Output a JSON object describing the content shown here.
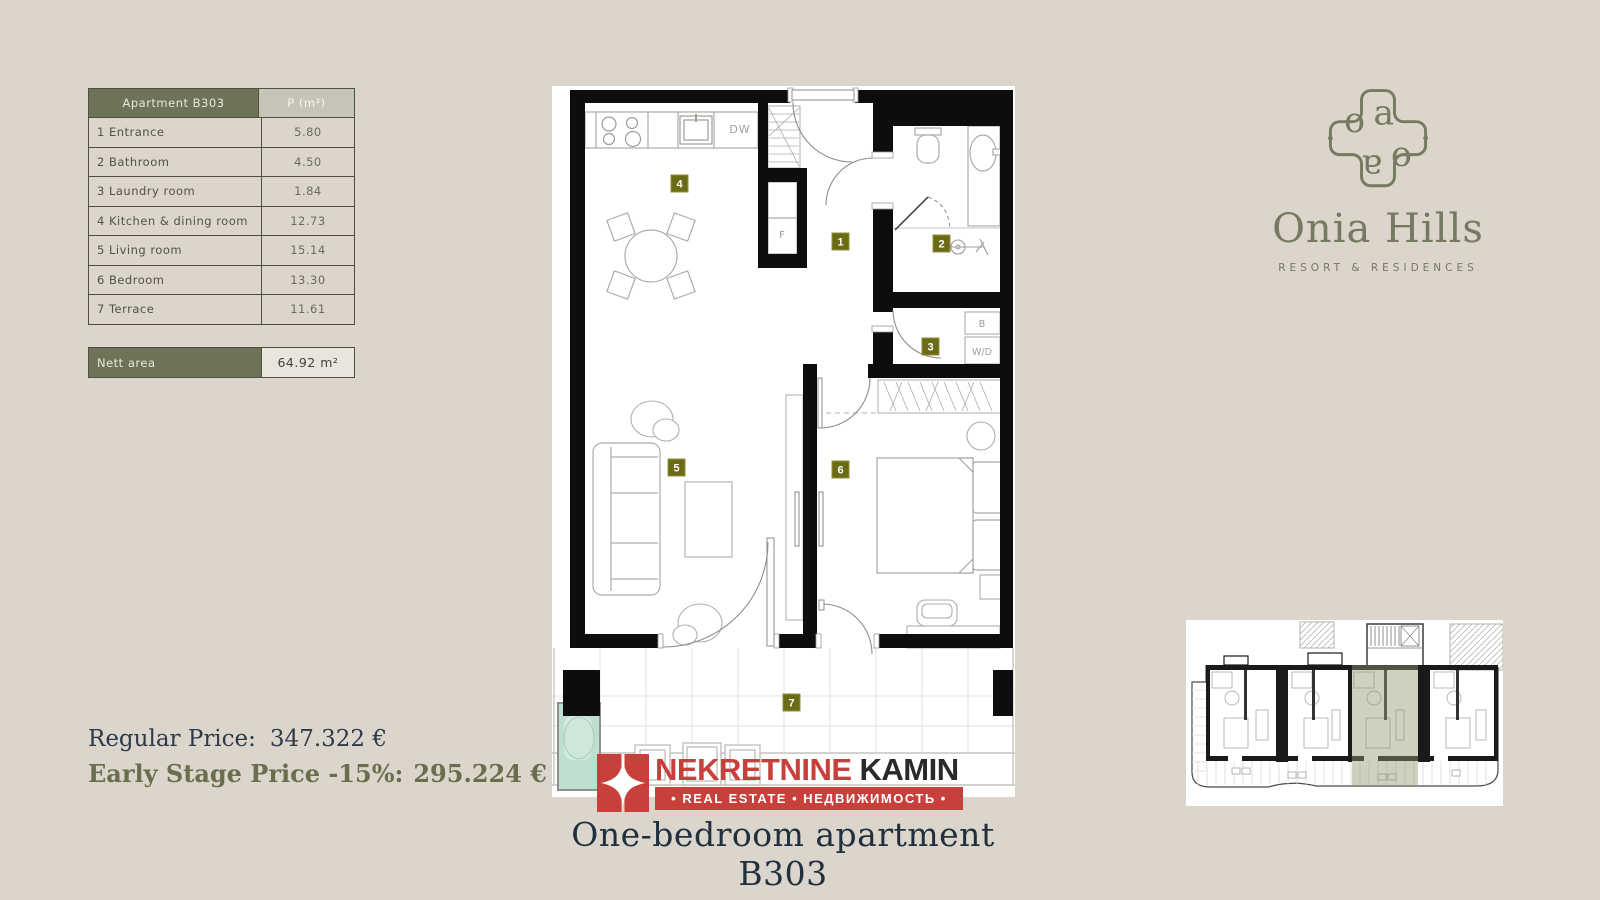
{
  "page": {
    "title": "One-bedroom apartment B303"
  },
  "area_table": {
    "header": {
      "name": "Apartment B303",
      "area": "P (m²)"
    },
    "rows": [
      {
        "label": "1 Entrance",
        "value": "5.80"
      },
      {
        "label": "2 Bathroom",
        "value": "4.50"
      },
      {
        "label": "3 Laundry room",
        "value": "1.84"
      },
      {
        "label": "4 Kitchen & dining room",
        "value": "12.73"
      },
      {
        "label": "5 Living room",
        "value": "15.14"
      },
      {
        "label": "6 Bedroom",
        "value": "13.30"
      },
      {
        "label": "7 Terrace",
        "value": "11.61"
      }
    ],
    "nett": {
      "label": "Nett area",
      "value": "64.92 m²"
    }
  },
  "brand": {
    "name": "Onia Hills",
    "tagline": "RESORT & RESIDENCES",
    "monogram": {
      "o": "o",
      "a": "a"
    }
  },
  "pricing": {
    "regular_label": "Regular Price:",
    "regular_value": "347.322 €",
    "early_label": "Early Stage Price -15%:",
    "early_value": "295.224 €"
  },
  "agency": {
    "name_primary": "NEKRETNINE",
    "name_secondary": "KAMIN",
    "banner": "• REAL ESTATE • НЕДВИЖИМОСТЬ •"
  },
  "floorplan": {
    "badges": [
      "1",
      "2",
      "3",
      "4",
      "5",
      "6",
      "7"
    ],
    "labels": {
      "dishwasher": "DW",
      "fridge": "F",
      "boiler": "B",
      "washer": "W/D"
    }
  },
  "colors": {
    "background": "#dcd5cb",
    "olive": "#6d7259",
    "badge_olive": "#6b6b15",
    "agency_red": "#c8403b",
    "dark_navy": "#20303f",
    "pool_teal": "#bedfd0",
    "highlight_unit": "#8e9a74"
  }
}
